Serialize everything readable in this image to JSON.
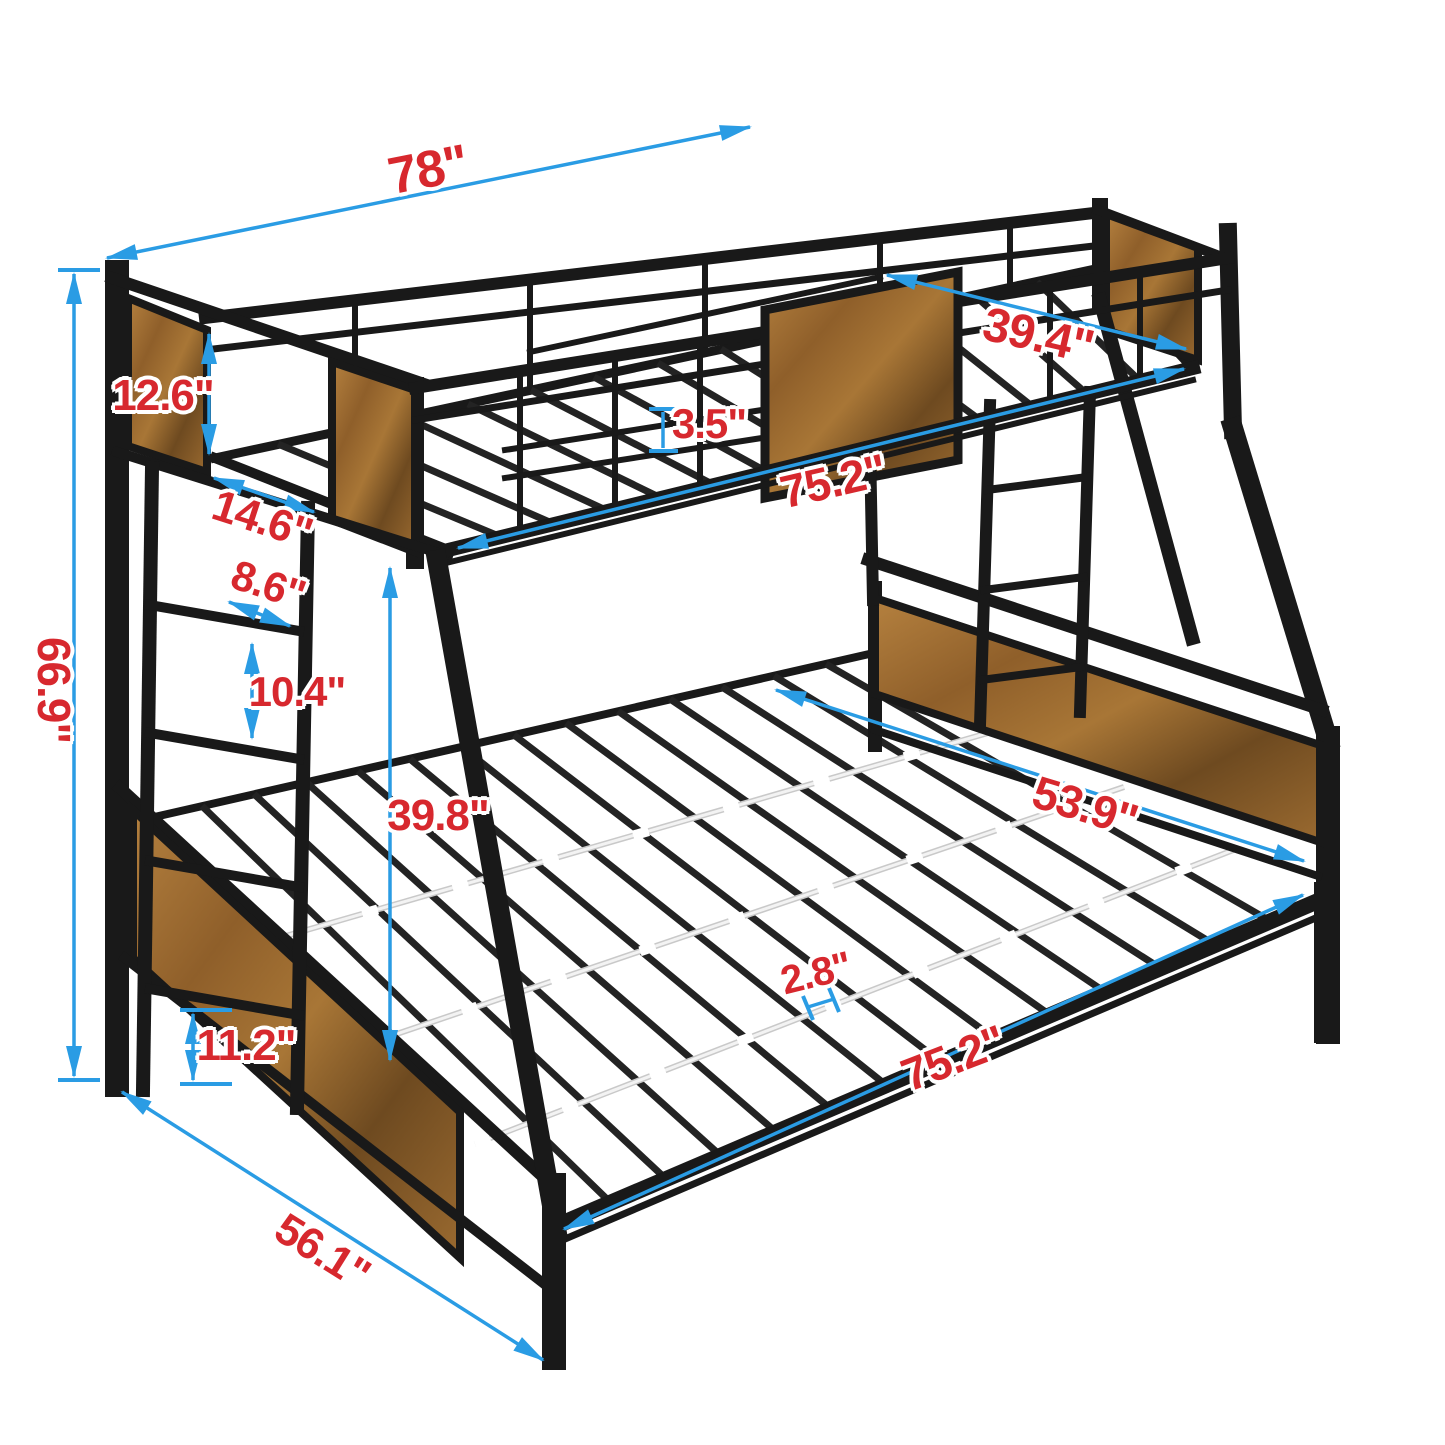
{
  "figure": {
    "description": "Twin-over-full metal bunk bed with rustic wood panels — product dimension diagram on white background"
  },
  "colors": {
    "bg": "#ffffff",
    "dim_line": "#2a9ce4",
    "dim_text": "#d7282e",
    "metal": "#191919",
    "wood_light": "#b5813f",
    "wood_mid": "#96662c",
    "wood_dark": "#5f3e18",
    "wire": "#e6e6e6"
  },
  "dims": {
    "d78": "78\"",
    "d66_9": "66.9\"",
    "d12_6": "12.6\"",
    "d14_6": "14.6\"",
    "d8_6": "8.6\"",
    "d10_4": "10.4\"",
    "d3_5": "3.5\"",
    "d75_2_top": "75.2\"",
    "d39_4": "39.4\"",
    "d39_8": "39.8\"",
    "d53_9": "53.9\"",
    "d2_8": "2.8\"",
    "d75_2_bottom": "75.2\"",
    "d11_2": "11.2\"",
    "d56_1": "56.1\""
  },
  "values_in": [
    78,
    66.9,
    12.6,
    14.6,
    8.6,
    10.4,
    3.5,
    75.2,
    39.4,
    39.8,
    53.9,
    2.8,
    75.2,
    11.2,
    56.1
  ]
}
